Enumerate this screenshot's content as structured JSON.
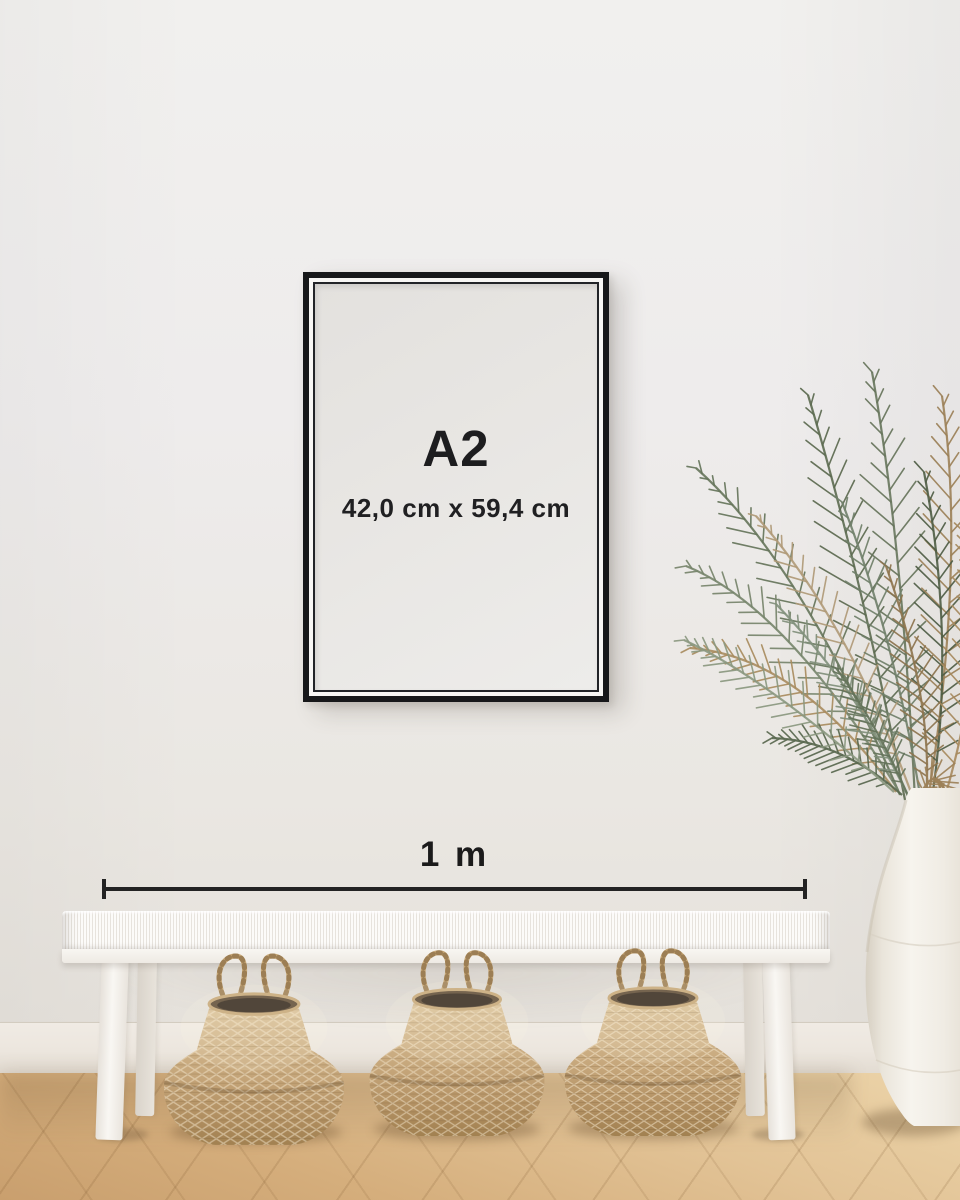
{
  "frame_label": {
    "size": "A2",
    "dimensions": "42,0 cm x 59,4 cm"
  },
  "scale_bar": {
    "label": "1 m"
  },
  "palette": {
    "frame_black": "#17181a",
    "annotation_text": "#1c1c1c",
    "poster_paper": "#e8e6e3",
    "wall": "#eeecea",
    "baseboard": "#ece6de",
    "floor_wood_light": "#e3c89d",
    "floor_wood_dark": "#c89e6e",
    "bench_white": "#f7f5f1",
    "basket_tan": "#c5a678",
    "basket_interior": "#51463a",
    "vase_white": "#f2efe9",
    "plant_green": "#66755a",
    "plant_dried": "#a98c5f"
  }
}
